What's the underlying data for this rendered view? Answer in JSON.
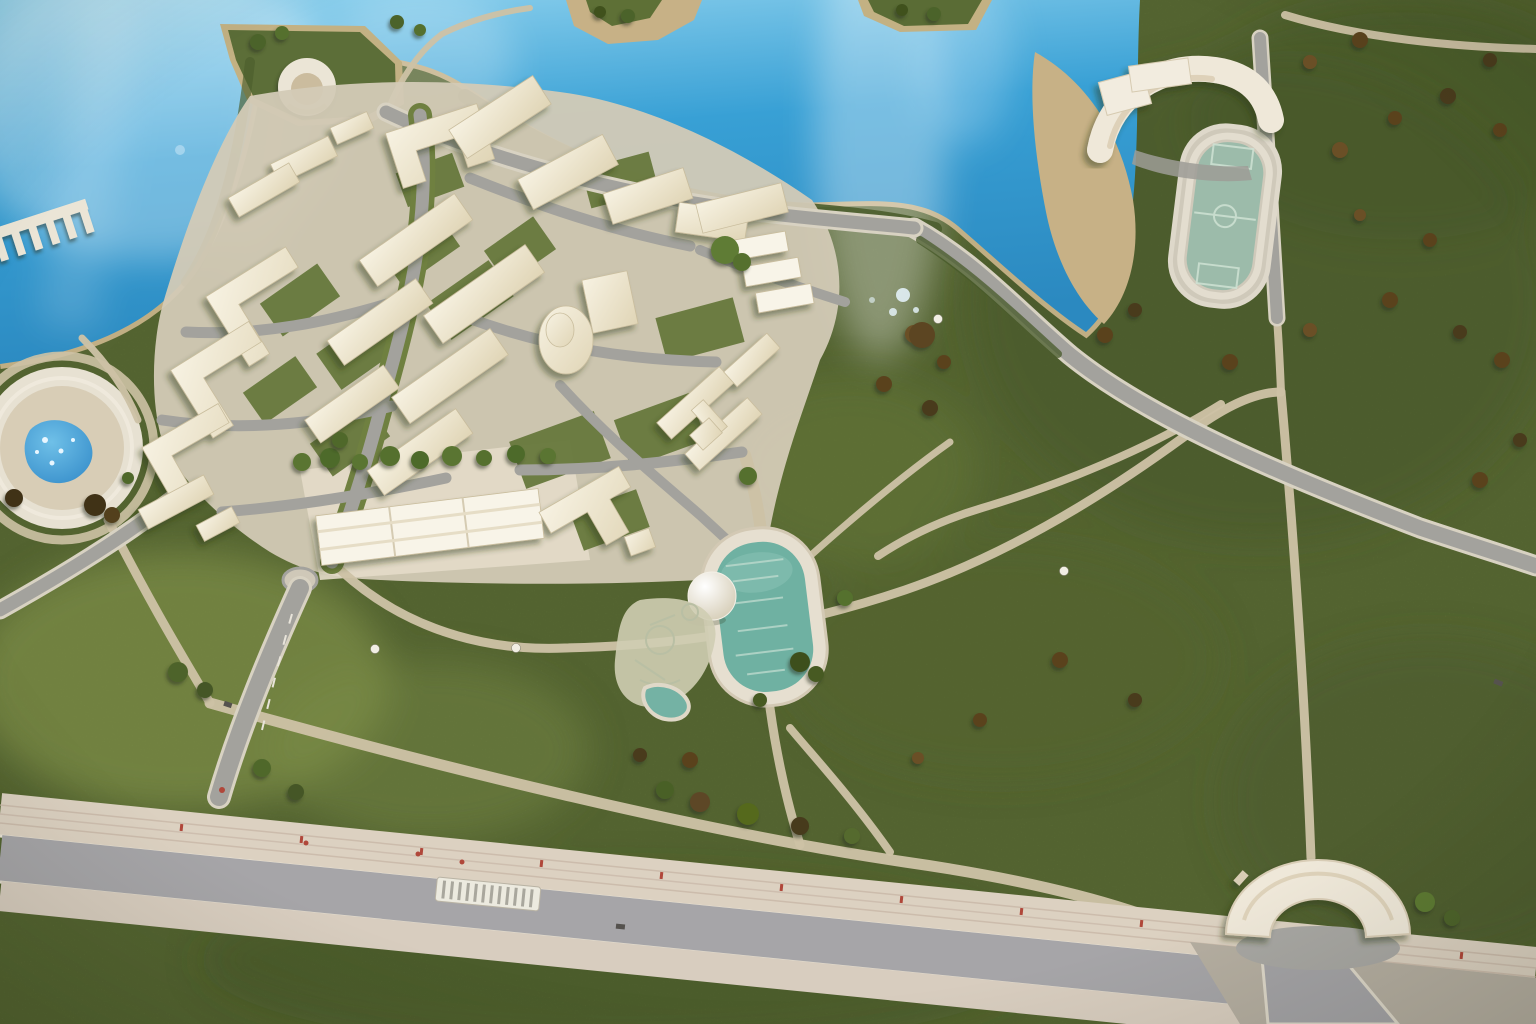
{
  "scene": {
    "kind": "photograph-of-architectural-scale-model",
    "view": "aerial-top-down",
    "subject": "waterfront urban-planning maquette: cream 3D-printed housing blocks on green flocked terrain beside bright blue water, with park paths, sports field, ponds, boulevard and amphitheater arch"
  },
  "palette": {
    "water": "#38a0d5",
    "water_light": "#93d4ef",
    "water_deep": "#2b89c0",
    "grass": "#5f7138",
    "grass_light": "#85954e",
    "grass_dark": "#47572c",
    "sand": "#c7b186",
    "path": "#cdc2a5",
    "road": "#a3a29d",
    "asphalt": "#a6a5a8",
    "sidewalk": "#dcd1c1",
    "plaza": "#d3cab6",
    "building": "#f7f2e2",
    "building_shade": "#e0d5b6",
    "structure_white": "#efe8d9",
    "pool_teal": "#6fb1a2",
    "field_teal": "#9cbbaa",
    "pond_blue": "#2f87c6",
    "tree_green": "#55702f",
    "bush_brown": "#5a421f",
    "accent_red": "#b0473a",
    "court_green": "#66783c",
    "hedge_green": "#4a5c2c",
    "dome_white": "#f4f0e7"
  },
  "features": [
    {
      "name": "lake",
      "kind": "water",
      "center": [
        180,
        140
      ]
    },
    {
      "name": "lagoon",
      "kind": "water",
      "center": [
        950,
        140
      ]
    },
    {
      "name": "sand-island",
      "kind": "landform",
      "center": [
        630,
        20
      ]
    },
    {
      "name": "islet",
      "kind": "landform",
      "center": [
        925,
        15
      ]
    },
    {
      "name": "headland",
      "kind": "landform",
      "center": [
        310,
        78
      ]
    },
    {
      "name": "crater-fountain",
      "kind": "structure",
      "center": [
        307,
        87
      ]
    },
    {
      "name": "pier",
      "kind": "structure",
      "center": [
        40,
        225
      ]
    },
    {
      "name": "housing-cluster",
      "kind": "buildings",
      "center": [
        480,
        330
      ]
    },
    {
      "name": "round-tower",
      "kind": "building",
      "center": [
        566,
        340
      ]
    },
    {
      "name": "terraced-row",
      "kind": "building",
      "center": [
        430,
        528
      ]
    },
    {
      "name": "school-h-building",
      "kind": "building",
      "center": [
        700,
        408
      ]
    },
    {
      "name": "central-oval-pond",
      "kind": "water-feature",
      "center": [
        763,
        615
      ]
    },
    {
      "name": "dome-pavilion",
      "kind": "structure",
      "center": [
        712,
        596
      ]
    },
    {
      "name": "playground",
      "kind": "park-feature",
      "center": [
        663,
        652
      ]
    },
    {
      "name": "kidney-pool",
      "kind": "water-feature",
      "center": [
        665,
        703
      ]
    },
    {
      "name": "circular-basin",
      "kind": "water-feature",
      "center": [
        62,
        448
      ]
    },
    {
      "name": "sports-field",
      "kind": "park-feature",
      "center": [
        1224,
        216
      ]
    },
    {
      "name": "grandstand",
      "kind": "structure",
      "center": [
        1185,
        105
      ]
    },
    {
      "name": "beach",
      "kind": "landform",
      "center": [
        1085,
        190
      ]
    },
    {
      "name": "amphitheater-arch",
      "kind": "structure",
      "center": [
        1318,
        900
      ]
    },
    {
      "name": "boulevard",
      "kind": "road",
      "center": [
        768,
        900
      ]
    },
    {
      "name": "tram-platform",
      "kind": "road-feature",
      "center": [
        488,
        893
      ]
    },
    {
      "name": "roundabout",
      "kind": "road-feature",
      "center": [
        300,
        580
      ]
    },
    {
      "name": "diagonal-road",
      "kind": "road",
      "center": [
        1220,
        480
      ]
    },
    {
      "name": "shore-road",
      "kind": "road",
      "center": [
        650,
        195
      ]
    },
    {
      "name": "north-south-road",
      "kind": "road",
      "center": [
        1270,
        170
      ]
    },
    {
      "name": "footpath-network",
      "kind": "paths",
      "center": [
        900,
        600
      ]
    },
    {
      "name": "street-lamps",
      "kind": "detail",
      "positions": [
        [
          375,
          649
        ],
        [
          516,
          648
        ],
        [
          938,
          319
        ],
        [
          1064,
          571
        ]
      ]
    },
    {
      "name": "scattered-trees-and-bushes",
      "kind": "vegetation",
      "center": [
        1200,
        300
      ]
    }
  ]
}
